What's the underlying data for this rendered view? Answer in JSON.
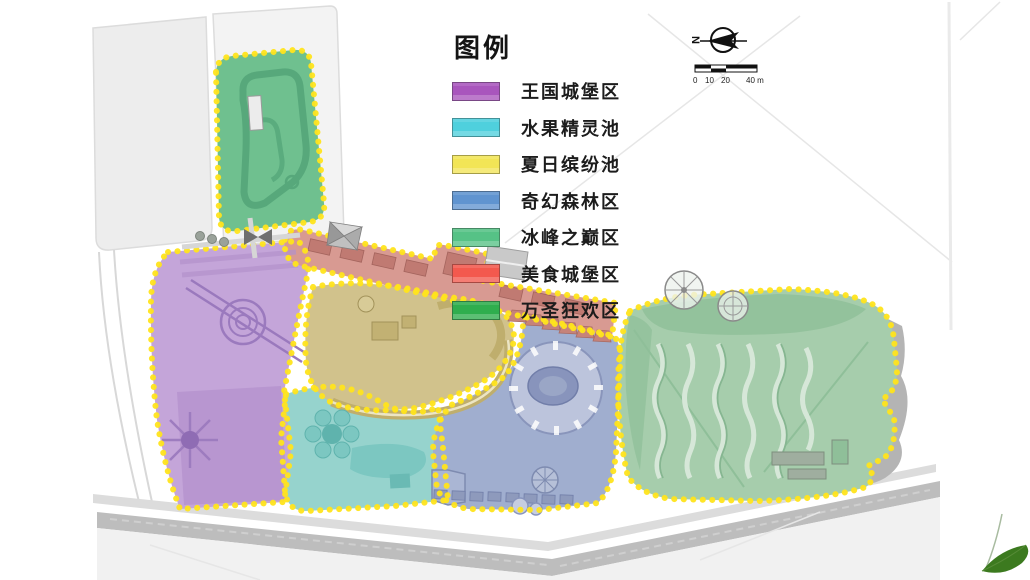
{
  "legend": {
    "title": "图例",
    "items": [
      {
        "label": "王国城堡区",
        "color": "#a956bd"
      },
      {
        "label": "水果精灵池",
        "color": "#4fd0dd"
      },
      {
        "label": "夏日缤纷池",
        "color": "#f2e556"
      },
      {
        "label": "奇幻森林区",
        "color": "#6094d0"
      },
      {
        "label": "冰峰之巅区",
        "color": "#56c286"
      },
      {
        "label": "美食城堡区",
        "color": "#f3594e"
      },
      {
        "label": "万圣狂欢区",
        "color": "#2fae4e"
      }
    ]
  },
  "compass": {
    "north_label": "N"
  },
  "scale_bar": {
    "labels": [
      "0",
      "10",
      "20",
      "40 m"
    ]
  },
  "map": {
    "border_color": "#ffe41c",
    "zone_fills": {
      "halloween_carnival": "#6fc08f",
      "kingdom_castle": "#c4a5d9",
      "summer_splash_pool": "#d1c28c",
      "fruit_fairy_pool": "#96d3cd",
      "fantasy_forest": "#a0aecf",
      "food_castle": "#d89a92",
      "ice_peak": "#a6cdac"
    }
  }
}
